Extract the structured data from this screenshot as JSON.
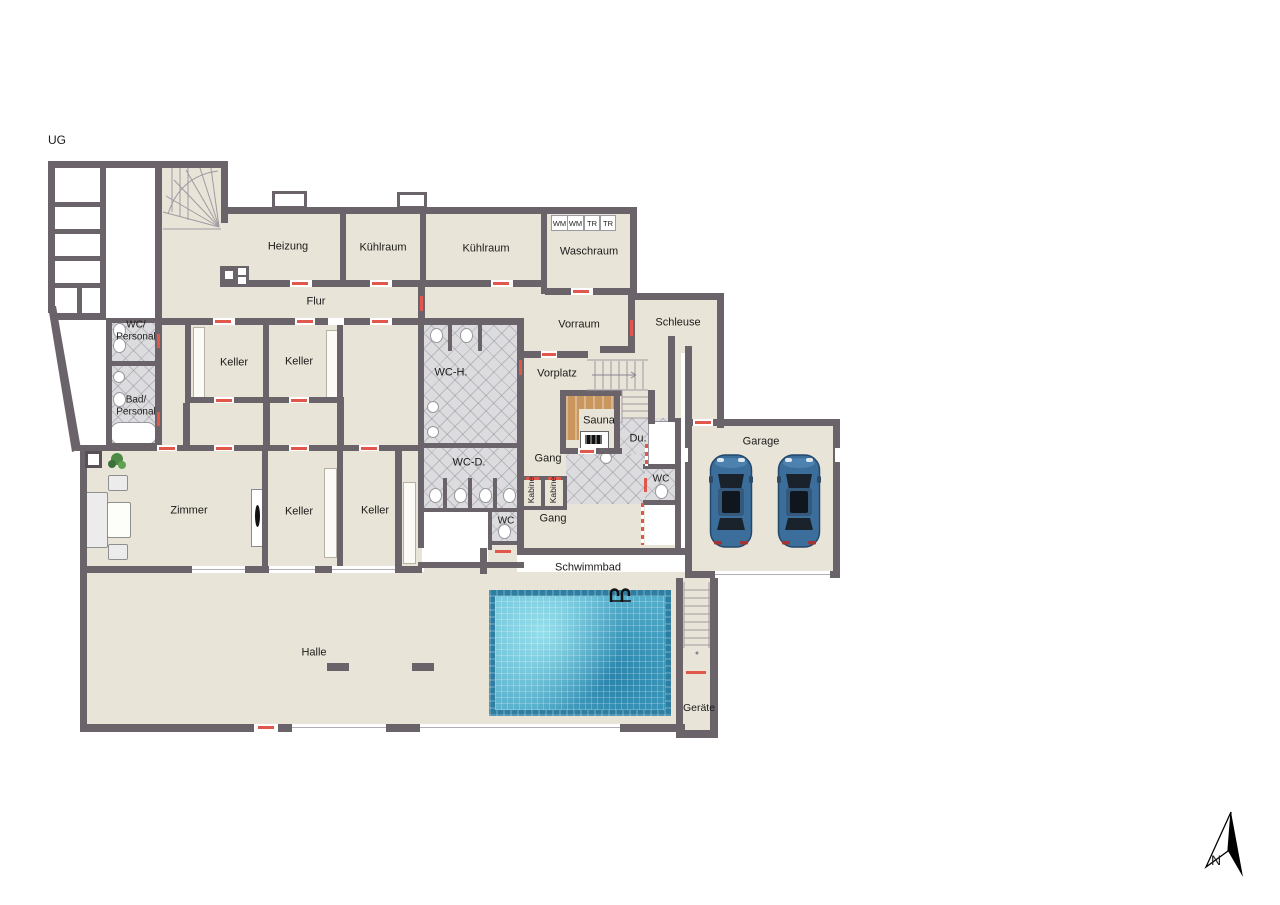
{
  "plan": {
    "floor_label": "UG",
    "compass": "N",
    "rooms": {
      "heizung": "Heizung",
      "kuehlraum_links": "Kühlraum",
      "kuehlraum_mitte": "Kühlraum",
      "waschraum": "Waschraum",
      "flur": "Flur",
      "vorraum": "Vorraum",
      "schleuse": "Schleuse",
      "wc_personal": "WC/\nPersonal",
      "bad_personal": "Bad/\nPersonal",
      "keller_1": "Keller",
      "keller_2": "Keller",
      "wc_herren": "WC-H.",
      "vorplatz": "Vorplatz",
      "sauna": "Sauna",
      "dusche": "Du.",
      "wc_dusche": "WC",
      "zimmer": "Zimmer",
      "keller_3": "Keller",
      "keller_4": "Keller",
      "wc_damen": "WC-D.",
      "gang_ober": "Gang",
      "kabine_1": "Kabine",
      "kabine_2": "Kabine",
      "wc_mitte": "WC",
      "gang_unter": "Gang",
      "garage": "Garage",
      "schwimmbad": "Schwimmbad",
      "halle": "Halle",
      "geraete": "Geräte"
    },
    "appliances": {
      "wm_1": "WM",
      "wm_2": "WM",
      "tr_1": "TR",
      "tr_2": "TR"
    }
  },
  "colors": {
    "wall": "#6a646a",
    "floor": "#e9e4d8",
    "tile": "#dcdcdf",
    "pool_water": "#55b1d2",
    "sauna_bench": "#c9965e",
    "door_marker": "#e2574c",
    "car_body": "#3c6e9c",
    "background": "#ffffff"
  }
}
